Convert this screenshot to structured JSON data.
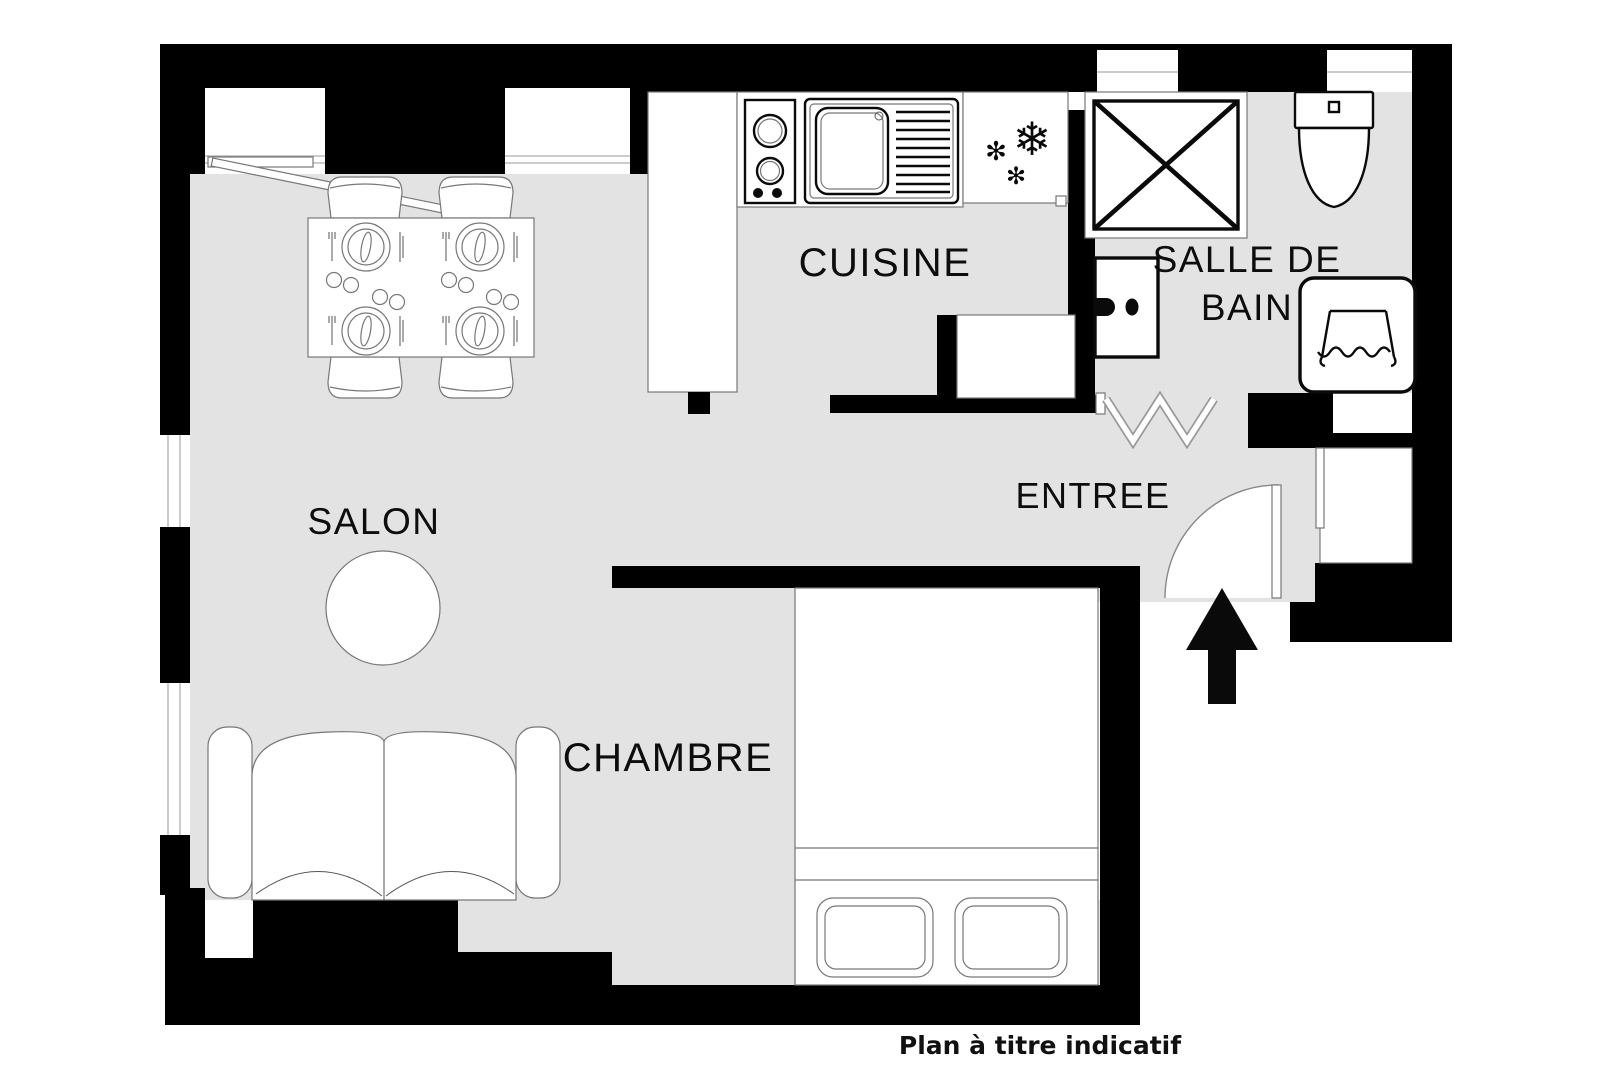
{
  "plan": {
    "rooms": {
      "salon": {
        "label": "SALON"
      },
      "cuisine": {
        "label": "CUISINE"
      },
      "salle_de_bain": {
        "line1": "SALLE DE",
        "line2": "BAIN"
      },
      "entree": {
        "label": "ENTREE"
      },
      "chambre": {
        "label": "CHAMBRE"
      }
    },
    "footnote": "Plan à titre indicatif",
    "icons": {
      "snowflake_large": "❄",
      "snowflake_small": "✻"
    },
    "colors": {
      "wall": "#000000",
      "floor": "#e3e3e3",
      "fixture_outline": "#0a0a0a",
      "furniture_outline": "#777777",
      "page": "#ffffff"
    }
  }
}
